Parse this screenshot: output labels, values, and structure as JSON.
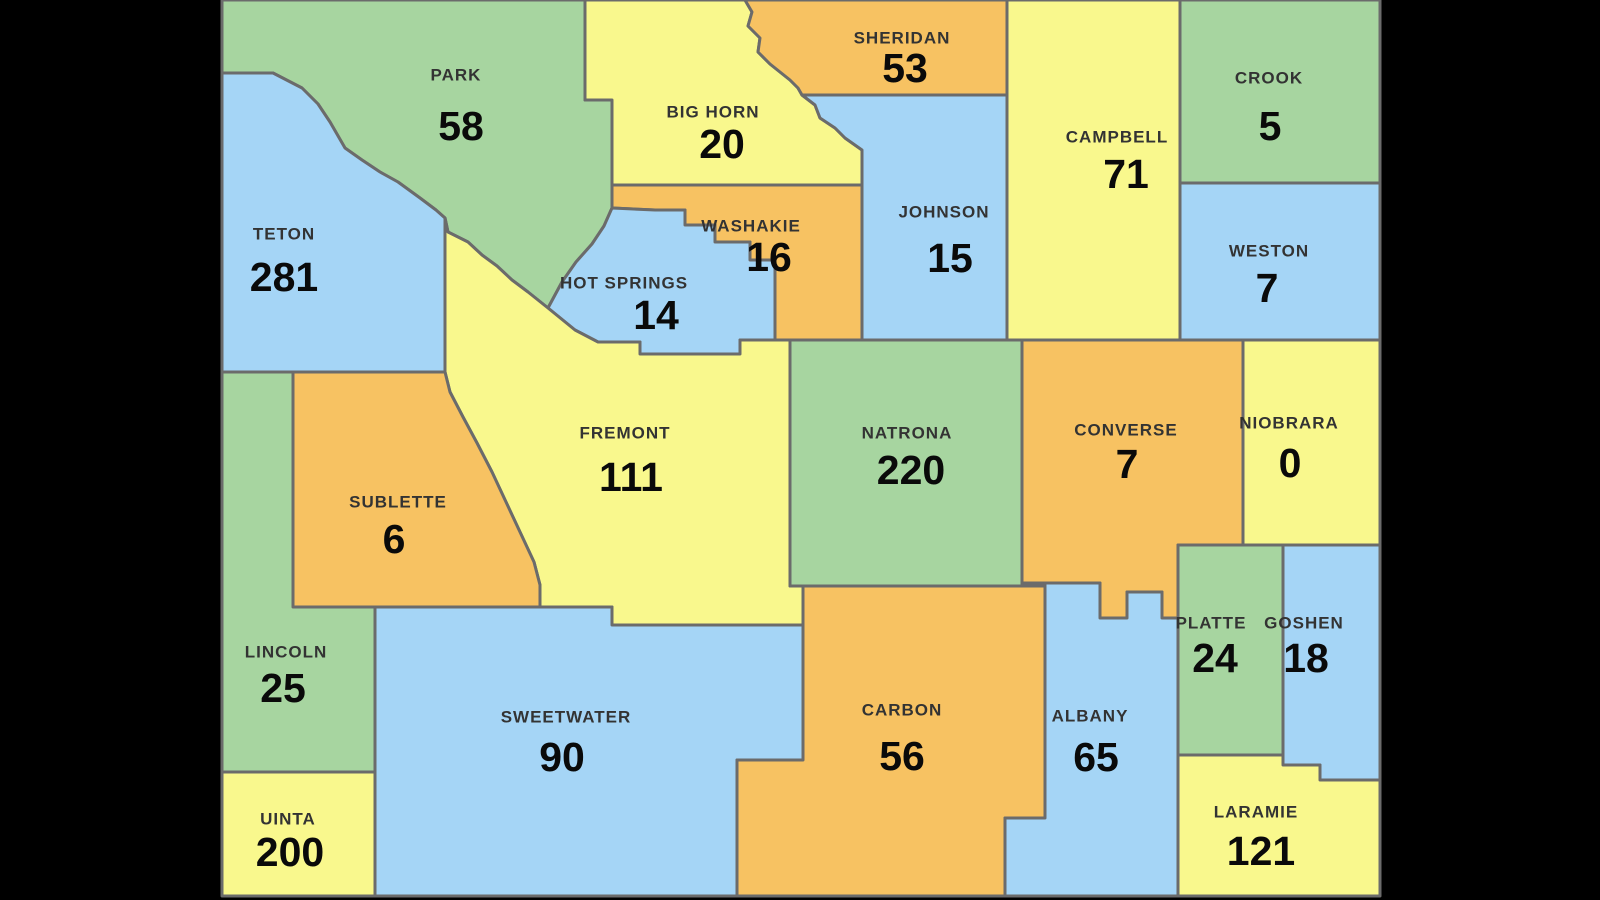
{
  "background_color": "#000000",
  "map": {
    "region": "Wyoming counties",
    "border_color": "#6b6b6b",
    "border_width": 3,
    "name_text_color": "#333333",
    "value_text_color": "#0a0a0a",
    "palette": {
      "green": "#a7d5a0",
      "yellow": "#f9f88d",
      "blue": "#a5d5f6",
      "orange": "#f7c262"
    },
    "counties": [
      {
        "name": "PARK",
        "value": 58,
        "color": "green"
      },
      {
        "name": "BIG HORN",
        "value": 20,
        "color": "yellow"
      },
      {
        "name": "SHERIDAN",
        "value": 53,
        "color": "orange"
      },
      {
        "name": "CAMPBELL",
        "value": 71,
        "color": "yellow"
      },
      {
        "name": "CROOK",
        "value": 5,
        "color": "green"
      },
      {
        "name": "WESTON",
        "value": 7,
        "color": "blue"
      },
      {
        "name": "JOHNSON",
        "value": 15,
        "color": "blue"
      },
      {
        "name": "TETON",
        "value": 281,
        "color": "blue"
      },
      {
        "name": "WASHAKIE",
        "value": 16,
        "color": "orange"
      },
      {
        "name": "HOT SPRINGS",
        "value": 14,
        "color": "blue"
      },
      {
        "name": "FREMONT",
        "value": 111,
        "color": "yellow"
      },
      {
        "name": "NATRONA",
        "value": 220,
        "color": "green"
      },
      {
        "name": "CONVERSE",
        "value": 7,
        "color": "orange"
      },
      {
        "name": "NIOBRARA",
        "value": 0,
        "color": "yellow"
      },
      {
        "name": "SUBLETTE",
        "value": 6,
        "color": "orange"
      },
      {
        "name": "LINCOLN",
        "value": 25,
        "color": "green"
      },
      {
        "name": "UINTA",
        "value": 200,
        "color": "yellow"
      },
      {
        "name": "SWEETWATER",
        "value": 90,
        "color": "blue"
      },
      {
        "name": "CARBON",
        "value": 56,
        "color": "orange"
      },
      {
        "name": "ALBANY",
        "value": 65,
        "color": "blue"
      },
      {
        "name": "PLATTE",
        "value": 24,
        "color": "green"
      },
      {
        "name": "GOSHEN",
        "value": 18,
        "color": "blue"
      },
      {
        "name": "LARAMIE",
        "value": 121,
        "color": "yellow"
      }
    ]
  }
}
